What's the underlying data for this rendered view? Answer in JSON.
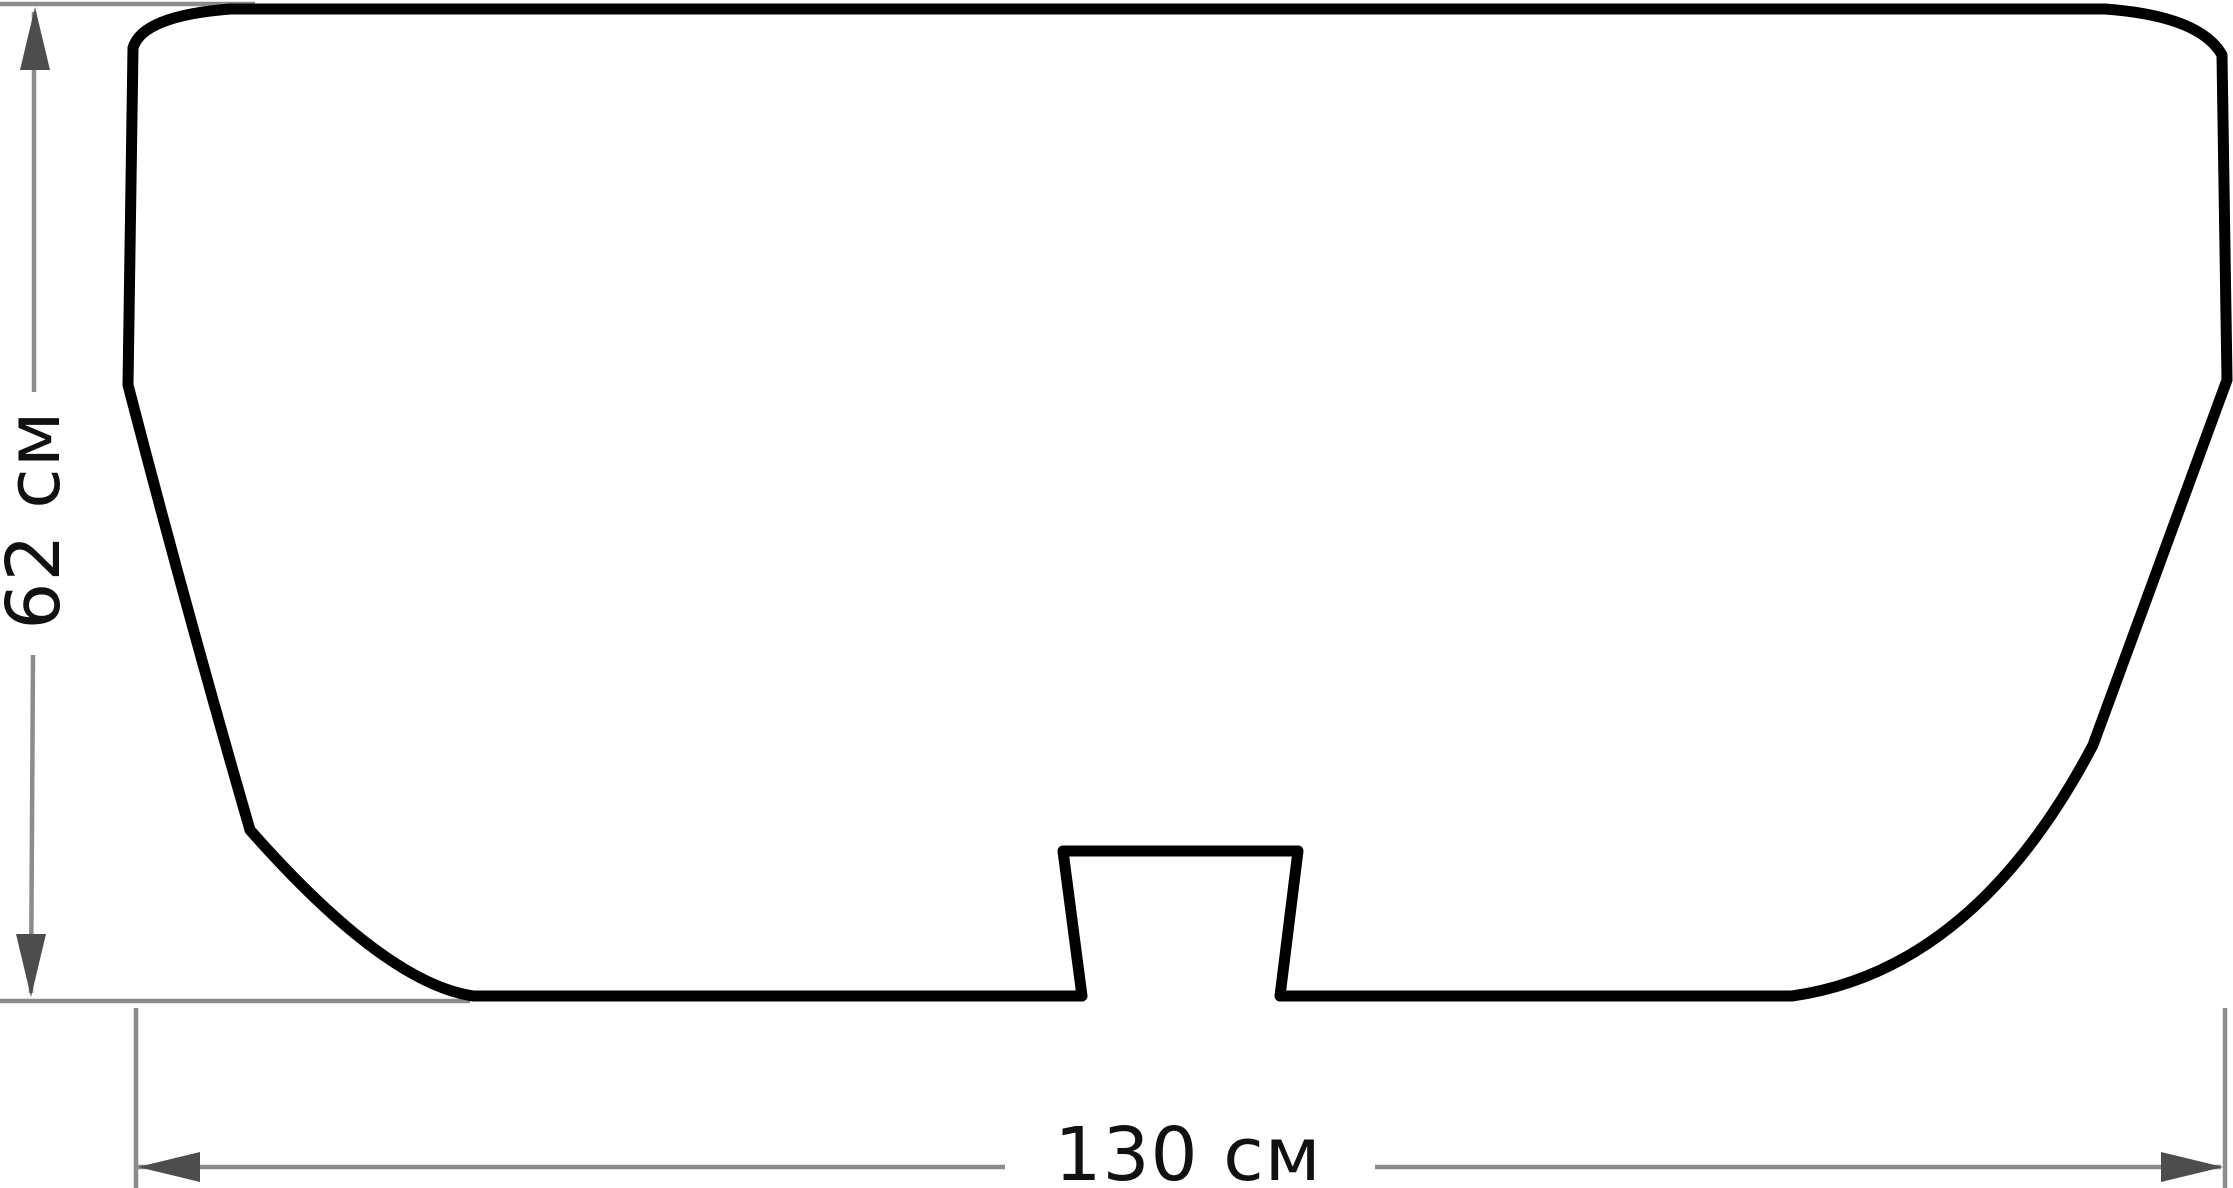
{
  "figure": {
    "height_dimension": {
      "label": "62 см",
      "value": "62",
      "unit": "см"
    },
    "width_dimension": {
      "label": "130 см",
      "value": "130",
      "unit": "см"
    }
  },
  "colors": {
    "background": "#ffffff",
    "outline": "#000000",
    "dimension_line": "#8c8c8c",
    "arrowhead": "#4d4d4d",
    "label_text": "#111111"
  }
}
